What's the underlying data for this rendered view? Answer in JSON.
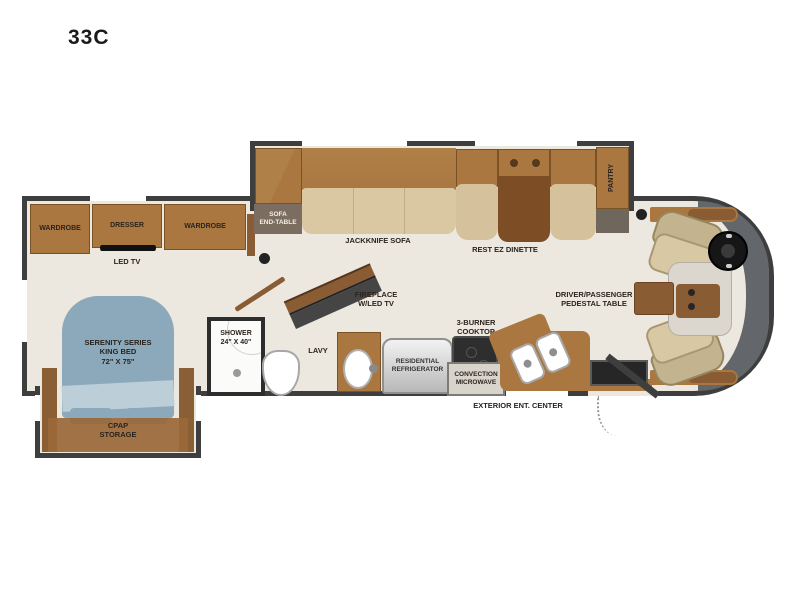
{
  "title": "33C",
  "colors": {
    "wall": "#3e3e3e",
    "floor": "#ece7df",
    "cabinet_brown": "#a9773f",
    "dark_wood": "#7d4e26",
    "bed_blue": "#8ba9ba",
    "sofa_tan": "#d9c8a2",
    "front_cap_gray": "#63666a"
  },
  "floorplan": {
    "bedroom": {
      "wardrobe_left": "WARDROBE",
      "dresser": "DRESSER",
      "led_tv": "LED TV",
      "wardrobe_right": "WARDROBE",
      "bed": "SERENITY SERIES\nKING BED\n72\" X 75\"",
      "cpap": "CPAP\nSTORAGE"
    },
    "bathroom": {
      "shower": "SHOWER\n24\" X 40\"",
      "lavy": "LAVY"
    },
    "living": {
      "sofa_end_table": "SOFA\nEND-TABLE",
      "jackknife_sofa": "JACKKNIFE SOFA",
      "rest_ez_dinette": "REST EZ DINETTE",
      "pantry": "PANTRY",
      "fireplace": "FIREPLACE\nW/LED TV"
    },
    "kitchen": {
      "refrigerator": "RESIDENTIAL\nREFRIGERATOR",
      "cooktop": "3-BURNER\nCOOKTOP",
      "microwave": "CONVECTION\nMICROWAVE",
      "exterior_ent_center": "EXTERIOR ENT. CENTER"
    },
    "cab": {
      "pedestal_table": "DRIVER/PASSENGER\nPEDESTAL TABLE"
    }
  }
}
